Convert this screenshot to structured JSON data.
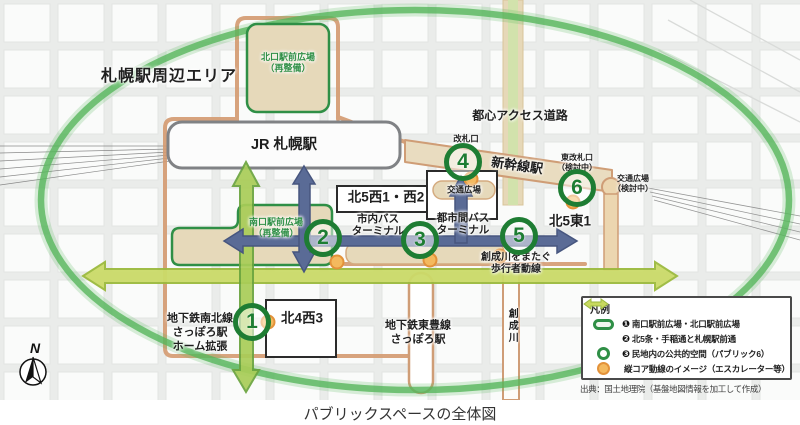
{
  "map": {
    "area_label": "札幌駅周辺エリア",
    "compass": "N",
    "labels": {
      "jr_station": "JR 札幌駅",
      "shinkansen_station": "新幹線駅",
      "north_plaza": "北口駅前広場\n（再整備）",
      "south_plaza": "南口駅前広場\n（再整備）",
      "ticket_gate": "改札口",
      "east_ticket_gate": "東改札口\n（検討中）",
      "transport_plaza": "交通広場",
      "transport_plaza_planned": "交通広場\n（検討中）",
      "access_road": "都心アクセス道路",
      "kita5_nishi": "北5西1・西2",
      "kita5_higashi": "北5東1",
      "kita4_nishi": "北4西3",
      "city_bus_terminal": "市内バス\nターミナル",
      "intercity_bus_terminal": "都市間バス\nターミナル",
      "sosei_crossing": "創成川をまたぐ\n歩行者動線",
      "sosei_river": "創成川",
      "namboku_line": "地下鉄南北線\nさっぽろ駅\nホーム拡張",
      "toho_line": "地下鉄東豊線\nさっぽろ駅"
    },
    "markers": [
      "1",
      "2",
      "3",
      "4",
      "5",
      "6"
    ]
  },
  "legend": {
    "title": "凡例",
    "items": [
      {
        "num": "❶",
        "label": "南口駅前広場・北口駅前広場"
      },
      {
        "num": "❷",
        "label": "北5条・手稲通と札幌駅前通"
      },
      {
        "num": "❸",
        "label": "民地内の公共的空間（パブリック6）"
      },
      {
        "num": "",
        "label": "縦コア動線のイメージ（エスカレーター等）"
      }
    ],
    "source": "出典：国土地理院（基盤地図情報を加工して作成）"
  },
  "caption": "パブリックスペースの全体図",
  "colors": {
    "ellipse_green": "#58b75c",
    "plaza_green": "#2f8f46",
    "marker_green": "#1e7d33",
    "route_salmon": "#d49a70",
    "arrow_yellow_green": "#cbdb69",
    "arrow_green": "#a9cd58",
    "arrow_blue": "#5a6b96",
    "node_orange": "#f4b95e",
    "plaza_tan": "#e6d9ba"
  }
}
